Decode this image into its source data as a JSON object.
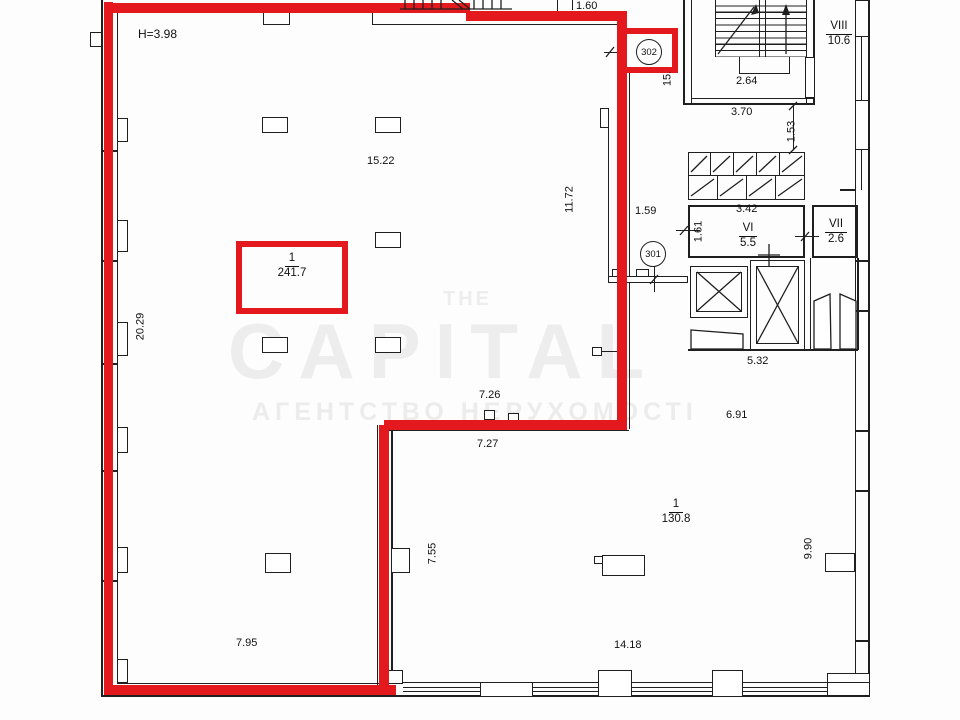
{
  "watermark": {
    "line_top": "THE",
    "line_main": "CAPITAL",
    "line_sub": "АГЕНТСТВО НЕРУХОМОСТІ"
  },
  "labels": {
    "height_note": "H=3.98",
    "room_main": {
      "num": "1",
      "area": "241.7"
    },
    "room_lower": {
      "num": "1",
      "area": "130.8"
    },
    "room_viii": {
      "num": "VIII",
      "area": "10.6"
    },
    "room_vi": {
      "num": "VI",
      "area": "5.5"
    },
    "room_vii": {
      "num": "VII",
      "area": "2.6"
    },
    "door_302": "302",
    "door_301": "301",
    "dims": {
      "d15_22": "15.22",
      "d11_72": "11.72",
      "d20_29": "20.29",
      "d1_60": "1.60",
      "d1_59": "1.59",
      "d2_64": "2.64",
      "d3_70": "3.70",
      "d1_53": "1.53",
      "d3_42": "3.42",
      "d1_61": "1.61",
      "d5_32": "5.32",
      "d6_91": "6.91",
      "d7_26": "7.26",
      "d7_27": "7.27",
      "d7_55": "7.55",
      "d7_95": "7.95",
      "d14_18": "14.18",
      "d9_90": "9.90",
      "d15_cut": "15."
    }
  },
  "colors": {
    "highlight_red": "#e3191e",
    "line_black": "#1f1f1f",
    "watermark_gray": "#ededed"
  }
}
